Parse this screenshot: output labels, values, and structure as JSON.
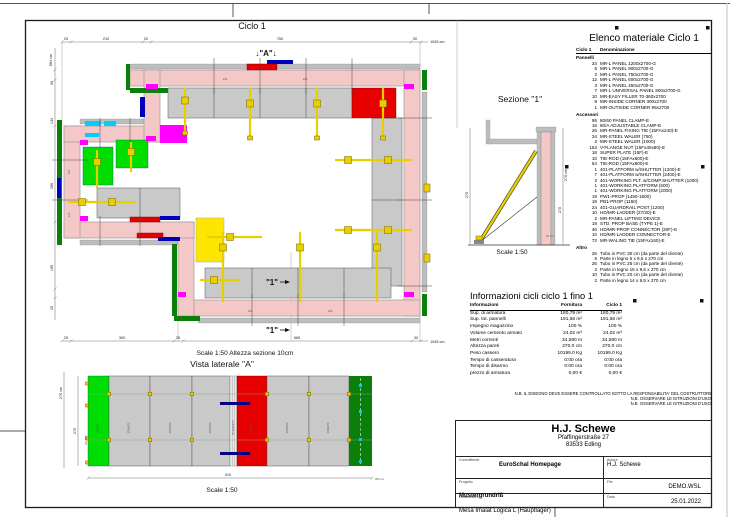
{
  "colors": {
    "wall_pink": "#f5c8c8",
    "panel_gray": "#c9c9c9",
    "form_gray": "#bdbdbd",
    "bright_green": "#00dd00",
    "dark_green": "#0a7f0a",
    "red": "#e60000",
    "magenta": "#ff00ff",
    "yellow": "#e8cf00",
    "yellow_panel": "#ffe600",
    "cyan": "#00ccff",
    "blue": "#0000bb",
    "navy": "#000080"
  },
  "plan": {
    "title": "Ciclo 1",
    "marker_a": "↓\"A\"↓",
    "marker_1": "\"1\"",
    "scale_note": "Scale 1:50   Altezza sezione 10cm",
    "dims_top": [
      "25",
      "210",
      "20",
      "760",
      "30"
    ],
    "dims_top_total": "1045 cm",
    "dims_bottom": [
      "25",
      "300",
      "25",
      "665",
      "30"
    ],
    "dims_bottom_total": "1045 cm",
    "dims_left": [
      "30",
      "134",
      "280",
      "195",
      "25"
    ],
    "dims_left_total": "664 cm",
    "panel_marks": [
      "120",
      "120",
      "120",
      "120",
      "120",
      "120"
    ]
  },
  "sezione": {
    "title": "Sezione \"1\"",
    "scale": "Scale 1:50",
    "dim_height": "270 cm",
    "dim_height2": "270",
    "dim_width": "20 cm"
  },
  "vista": {
    "title": "Vista laterale \"A\"",
    "scale": "Scale 1:50",
    "dim_left_total": "270 cm",
    "dim_left": "270",
    "dim_alt": "Alt. 270",
    "dim_bottom": "910",
    "dim_bottom_total": "950 cm",
    "panels": [
      "90x270",
      "120x270",
      "120x270",
      "120x270",
      "70-360x270",
      "90x270",
      "120x270",
      "120x270",
      "90x270"
    ]
  },
  "materiale": {
    "title": "Elenco materiale  Ciclo 1",
    "col_qty": "Ciclo 1",
    "col_name": "Denominazione",
    "sections": [
      {
        "name": "Pannelli",
        "rows": [
          {
            "q": "34",
            "n": "MR-L PANEL 1200x2700-G"
          },
          {
            "q": "6",
            "n": "MR-L PANEL 900x2700-G"
          },
          {
            "q": "2",
            "n": "MR-L PANEL 750x2700-G"
          },
          {
            "q": "12",
            "n": "MR-L PANEL 600x2700-G"
          },
          {
            "q": "3",
            "n": "MR-L PANEL 450x2700-G"
          },
          {
            "q": "7",
            "n": "MR-L UNIVERSAL PANEL 900x2700-G"
          },
          {
            "q": "10",
            "n": "MR-EASY FILLER 70-360x2700"
          },
          {
            "q": "8",
            "n": "MR-INSIDE CORNER 300x2700"
          },
          {
            "q": "1",
            "n": "MR-OUTSIDE CORNER 95x2700"
          }
        ]
      },
      {
        "name": "Accessori",
        "rows": [
          {
            "q": "95",
            "n": "80/60 PANEL CLAMP-E"
          },
          {
            "q": "16",
            "n": "80/A ADJUSTABLE CLAMP-E"
          },
          {
            "q": "26",
            "n": "MR-PANEL FIXING TIE (15FAx240)-E"
          },
          {
            "q": "34",
            "n": "MR-STEEL WALER (750)"
          },
          {
            "q": "2",
            "n": "MR-STEEL WALER (1000)"
          },
          {
            "q": "152",
            "n": "V-FLANGE NUT (15Fx40x80)-E"
          },
          {
            "q": "18",
            "n": "SUPER PLATE (15F)-E"
          },
          {
            "q": "10",
            "n": "TIE-ROD (15FAx600)-E"
          },
          {
            "q": "64",
            "n": "TIE-ROD (15FAx800)-E"
          },
          {
            "q": "1",
            "n": "401-PLATFORM w/SHUTTER (1200)-E"
          },
          {
            "q": "7",
            "n": "401-PLATFORM w/SHUTTER (2400)-E"
          },
          {
            "q": "2",
            "n": "401-WORKING PLT. w/COMP.SHUTTER (1000)"
          },
          {
            "q": "1",
            "n": "401-WORKING PLATFORM (600)"
          },
          {
            "q": "1",
            "n": "401-WORKING PLATFORM (2000)"
          },
          {
            "q": "19",
            "n": "PW1-PROP (1450-1800)"
          },
          {
            "q": "19",
            "n": "PB1-PROP (1150)"
          },
          {
            "q": "24",
            "n": "401-GUARDRAIL POST (1200)"
          },
          {
            "q": "10",
            "n": "HD/MR-LADDER (27/30)-E"
          },
          {
            "q": "2",
            "n": "MR-PANEL LIFTING DEVICE"
          },
          {
            "q": "19",
            "n": "STD. PROP BASE (TYPE 1)-E"
          },
          {
            "q": "46",
            "n": "HD/MR-PROP CONNECTOR (20F)-E"
          },
          {
            "q": "10",
            "n": "HD/MR-LADDER CONNECTOR-E"
          },
          {
            "q": "72",
            "n": "MR-WALING TIE (15FAx160)-E"
          }
        ]
      },
      {
        "name": "Altro",
        "rows": [
          {
            "q": "26",
            "n": "Tubo in PVC 30 cm (da parte del cliente)"
          },
          {
            "q": "5",
            "n": "Parte in legno 5 x 9,5 x 270 cm"
          },
          {
            "q": "26",
            "n": "Tubo in PVC 25 cm (da parte del cliente)"
          },
          {
            "q": "2",
            "n": "Parte in legno 15 x 9,5 x 270 cm"
          },
          {
            "q": "10",
            "n": "Tubo in PVC 20 cm (da parte del cliente)"
          },
          {
            "q": "2",
            "n": "Parte in legno 14 x 9,5 x 270 cm"
          }
        ]
      }
    ]
  },
  "informazioni": {
    "title": "Informazioni cicli  ciclo 1 fino 1",
    "cols": [
      "Informazioni",
      "Fornitura",
      "Ciclo 1"
    ],
    "rows": [
      {
        "l": "Sup. di armatura",
        "f": "180,79 m²",
        "c": "180,79 m²"
      },
      {
        "l": "Sup. tot. pannelli",
        "f": "191,56 m²",
        "c": "191,56 m²"
      },
      {
        "l": "Impegno magazzino",
        "f": "100 %",
        "c": "100 %"
      },
      {
        "l": "Volume cemento armato",
        "f": "24,02 m³",
        "c": "24,02 m³"
      },
      {
        "l": "Metri correnti",
        "f": "34,580 m",
        "c": "34,580 m"
      },
      {
        "l": "Altezza pareti",
        "f": "270,0 cm",
        "c": "270,0 cm"
      },
      {
        "l": "Peso cassero",
        "f": "10199,0 Kg",
        "c": "10199,0 Kg"
      },
      {
        "l": "Tempo di casseratura",
        "f": "0:00 ora",
        "c": "0:00 ora"
      },
      {
        "l": "Tempo di disarmo",
        "f": "0:00 ora",
        "c": "0:00 ora"
      },
      {
        "l": "prezzo di armatura",
        "f": "0,00 €",
        "c": "0,00 €"
      }
    ]
  },
  "notes": [
    "N.B. IL DISEGNO DEVE ESSERE CONTROLLATO SOTTO LA RESPONSABILITA' DEL COSTRUTTORE",
    "N.B. OSSERVARE LE ISTRUZIONI D'USO!",
    "N.B. OSSERVARE LE ISTRUZIONI D'USO!"
  ],
  "titleblock": {
    "company": "H.J. Schewe",
    "address1": "Pfaffingerstraße 27",
    "address2": "83533 Edling",
    "committente_label": "Committente",
    "committente": "EuroSchal Homepage",
    "progetto_label": "Progetto",
    "progetto": "Mustergrundriß",
    "casseratura_label": "Casseratura",
    "casseratura": "Mesa Imalat Logica L (Hauptlager)",
    "autore_label": "Autore",
    "autore": "H.J. Schewe",
    "file_label": "File",
    "file": "DEMO.WSL",
    "data_label": "Data",
    "data": "25.01.2022"
  }
}
